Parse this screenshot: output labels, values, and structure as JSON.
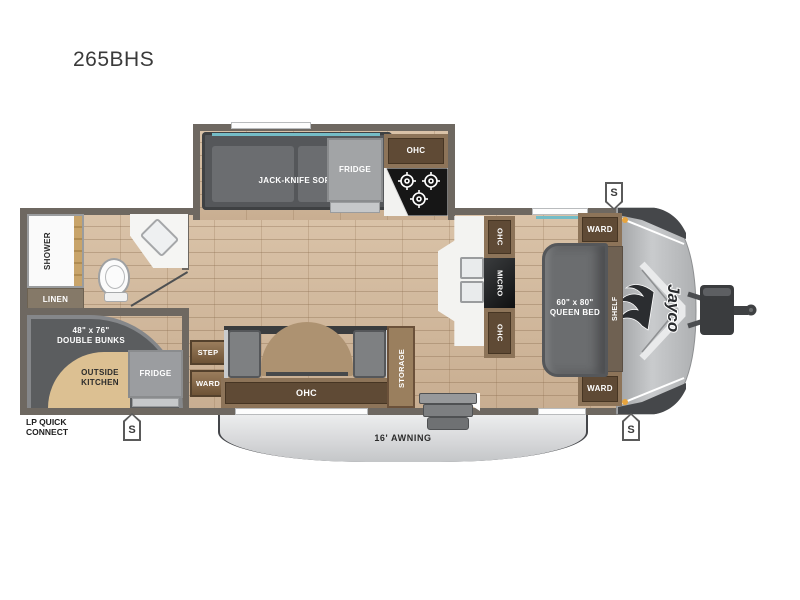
{
  "title": "265BHS",
  "colors": {
    "wall": "#6e6861",
    "floor_wood": "#cdb49a",
    "window_accent": "#74bcc6",
    "cabinet_wood_frame": "#8d7459",
    "cabinet_wood_dark": "#5f4a35",
    "cushion_gray": "#5b5d5f",
    "outside_kitchen_tan": "#dcc092",
    "awning_gray": "#d9dadb",
    "front_cap_gray": "#b5b7b9",
    "marker_orange": "#e7a43e"
  },
  "slideout": {
    "sofa": "JACK-KNIFE SOFA",
    "fridge": "FRIDGE",
    "ohc": "OHC"
  },
  "bathroom": {
    "shower": "SHOWER",
    "linen": "LINEN"
  },
  "bunk_room": {
    "size": "48\" x 76\"",
    "label": "DOUBLE BUNKS",
    "outside_kitchen_line1": "OUTSIDE",
    "outside_kitchen_line2": "KITCHEN",
    "fridge": "FRIDGE"
  },
  "hall": {
    "step": "STEP",
    "ward": "WARD"
  },
  "dinette": {
    "ohc": "OHC",
    "storage": "STORAGE"
  },
  "kitchen": {
    "ohc_top": "OHC",
    "micro": "MICRO",
    "ohc_bottom": "OHC"
  },
  "bedroom": {
    "size": "60\" x 80\"",
    "label": "QUEEN BED",
    "ward_top": "WARD",
    "ward_bottom": "WARD",
    "shelf": "SHELF"
  },
  "exterior": {
    "awning": "16' AWNING",
    "lp_line1": "LP QUICK",
    "lp_line2": "CONNECT",
    "speaker": "S",
    "brand": "Jayco"
  }
}
